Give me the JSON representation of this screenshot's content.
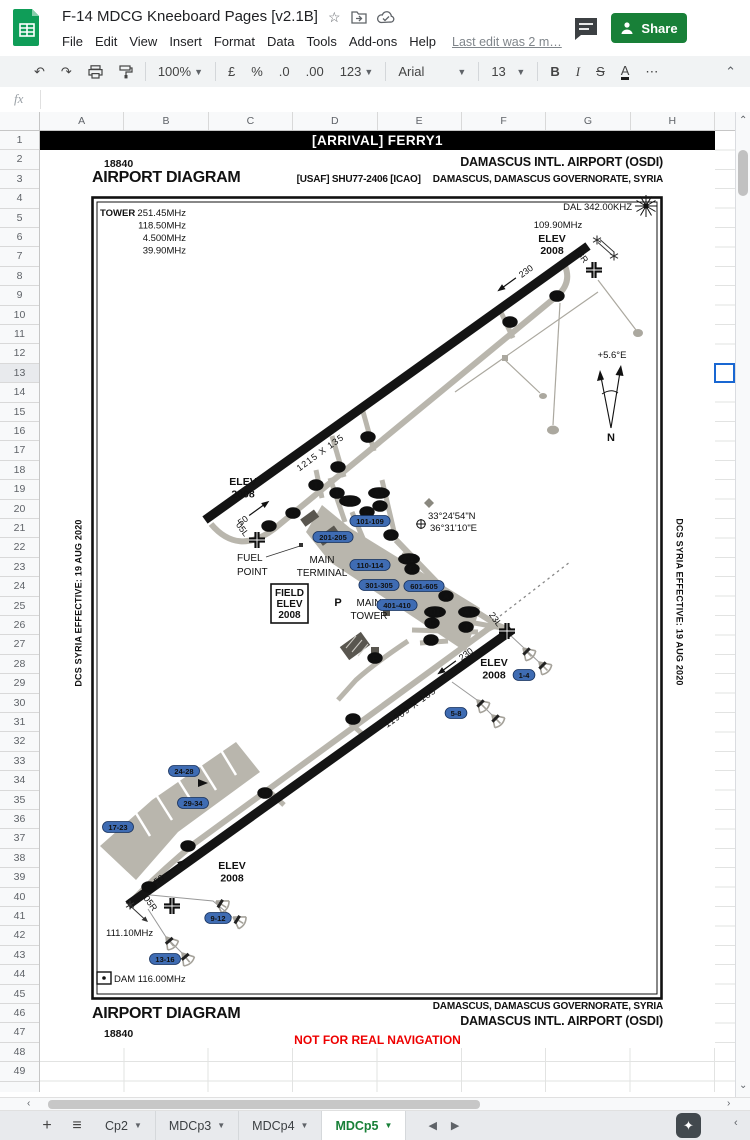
{
  "titlebar": {
    "title": "F-14 MDCG Kneeboard Pages [v2.1B]",
    "menus": [
      "File",
      "Edit",
      "View",
      "Insert",
      "Format",
      "Data",
      "Tools",
      "Add-ons",
      "Help"
    ],
    "last_edit": "Last edit was 2 m…",
    "share_label": "Share"
  },
  "toolbar": {
    "zoom_value": "100%",
    "currency": "£",
    "percent": "%",
    "dec_decrease": ".0",
    "dec_increase": ".00",
    "more_formats": "123",
    "font_name": "Arial",
    "font_size": "13",
    "bold": "B",
    "italic": "I",
    "strikethrough": "S",
    "text_color": "A",
    "more": "⋯"
  },
  "formula_bar": {
    "fx_label": "fx"
  },
  "grid": {
    "columns": [
      "A",
      "B",
      "C",
      "D",
      "E",
      "F",
      "G",
      "H"
    ],
    "row_count": 49,
    "selected_row": 13
  },
  "tabs": {
    "add_label": "+",
    "items": [
      {
        "label": "Cp2",
        "active": false
      },
      {
        "label": "MDCp3",
        "active": false
      },
      {
        "label": "MDCp4",
        "active": false
      },
      {
        "label": "MDCp5",
        "active": true
      }
    ]
  },
  "diagram": {
    "banner": "[ARRIVAL] FERRY1",
    "chart_number": "18840",
    "title": "AIRPORT DIAGRAM",
    "airport_name": "DAMASCUS  INTL. AIRPORT  (OSDI)",
    "chart_code": "[USAF] SHU77-2406 [ICAO]",
    "location": "DAMASCUS, DAMASCUS GOVERNORATE,  SYRIA",
    "tower": {
      "label": "TOWER",
      "f1": "251.45MHz",
      "f2": "118.50MHz",
      "f3": "4.500MHz",
      "f4": "39.90MHz"
    },
    "dal": "DAL 342.00KHZ",
    "freq_109": "109.90MHz",
    "freq_111": "111.10MHz",
    "dam": "DAM 116.00MHz",
    "elev_label": "ELEV",
    "elev_value": "2008",
    "field_elev": {
      "l1": "FIELD",
      "l2": "ELEV",
      "l3": "2008"
    },
    "fuel": {
      "l1": "FUEL",
      "l2": "POINT"
    },
    "terminal": {
      "l1": "MAIN",
      "l2": "TERMINAL"
    },
    "tower_bldg": {
      "l1": "MAIN",
      "l2": "TOWER"
    },
    "coords": {
      "lat": "33°24'54\"N",
      "lon": "36°31'10\"E"
    },
    "magvar": "+5.6°E",
    "north": "N",
    "p_label": "P",
    "rwy_upper": {
      "dim": "1215 X 135",
      "id_sw": "05L",
      "id_ne": "23R",
      "hdg_ne": "230",
      "hdg_sw": "50"
    },
    "rwy_lower": {
      "dim": "11909 X 185",
      "id_sw": "05R",
      "id_ne": "23L",
      "hdg_ne": "230",
      "hdg_sw": "50"
    },
    "side_note": "DCS SYRIA EFFECTIVE: 19 AUG 2020",
    "taxiway_labels": [
      "Q",
      "O",
      "R",
      "S",
      "T",
      "I",
      "A1",
      "B1",
      "N",
      "B",
      "O",
      "U",
      "A",
      "C1",
      "C",
      "A",
      "D1",
      "A1",
      "E",
      "J",
      "K",
      "F",
      "I",
      "H",
      "K",
      "G"
    ],
    "gate_labels": [
      "101-109",
      "201-205",
      "110-114",
      "301-305",
      "601-605",
      "401-410",
      "1-4",
      "5-8",
      "24-28",
      "29-34",
      "17-23",
      "9-12",
      "13-16"
    ],
    "footer": {
      "title": "AIRPORT DIAGRAM",
      "number": "18840",
      "location": "DAMASCUS, DAMASCUS GOVERNORATE,  SYRIA",
      "airport": "DAMASCUS  INTL. AIRPORT  (OSDI)",
      "warning": "NOT FOR REAL NAVIGATION"
    }
  }
}
